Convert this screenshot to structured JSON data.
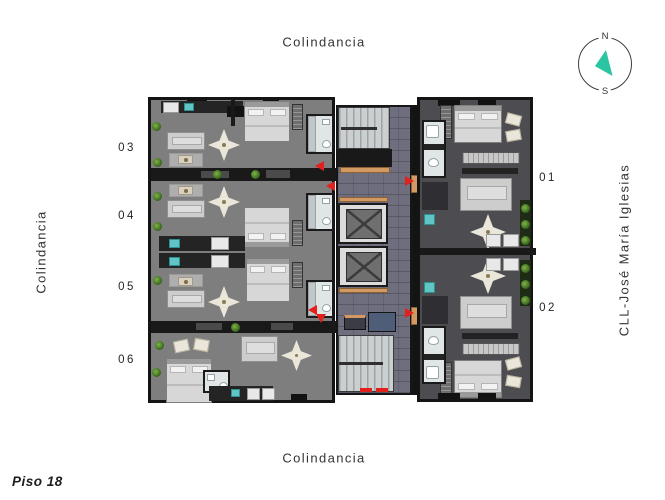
{
  "title": {
    "floor_label": "Piso 18"
  },
  "boundaries": {
    "top": "Colindancia",
    "left": "Colindancia",
    "bottom": "Colindancia",
    "right_street": "CLL-José María Iglesias"
  },
  "compass": {
    "north": "N",
    "south": "S"
  },
  "units": [
    {
      "label": "03",
      "side": "left"
    },
    {
      "label": "04",
      "side": "left"
    },
    {
      "label": "05",
      "side": "left"
    },
    {
      "label": "06",
      "side": "left"
    },
    {
      "label": "01",
      "side": "right"
    },
    {
      "label": "02",
      "side": "right"
    }
  ],
  "colors": {
    "entry_arrow_red": "#e3201b",
    "compass_needle_teal": "#2cc5a4",
    "corridor_tile": "#6f6e7e",
    "wood_threshold": "#d29a62",
    "fixture_teal": "#62c5c5",
    "left_block_floor": "#7e7e7e",
    "right_block_floor": "#4c4c51",
    "wall": "#141414"
  }
}
